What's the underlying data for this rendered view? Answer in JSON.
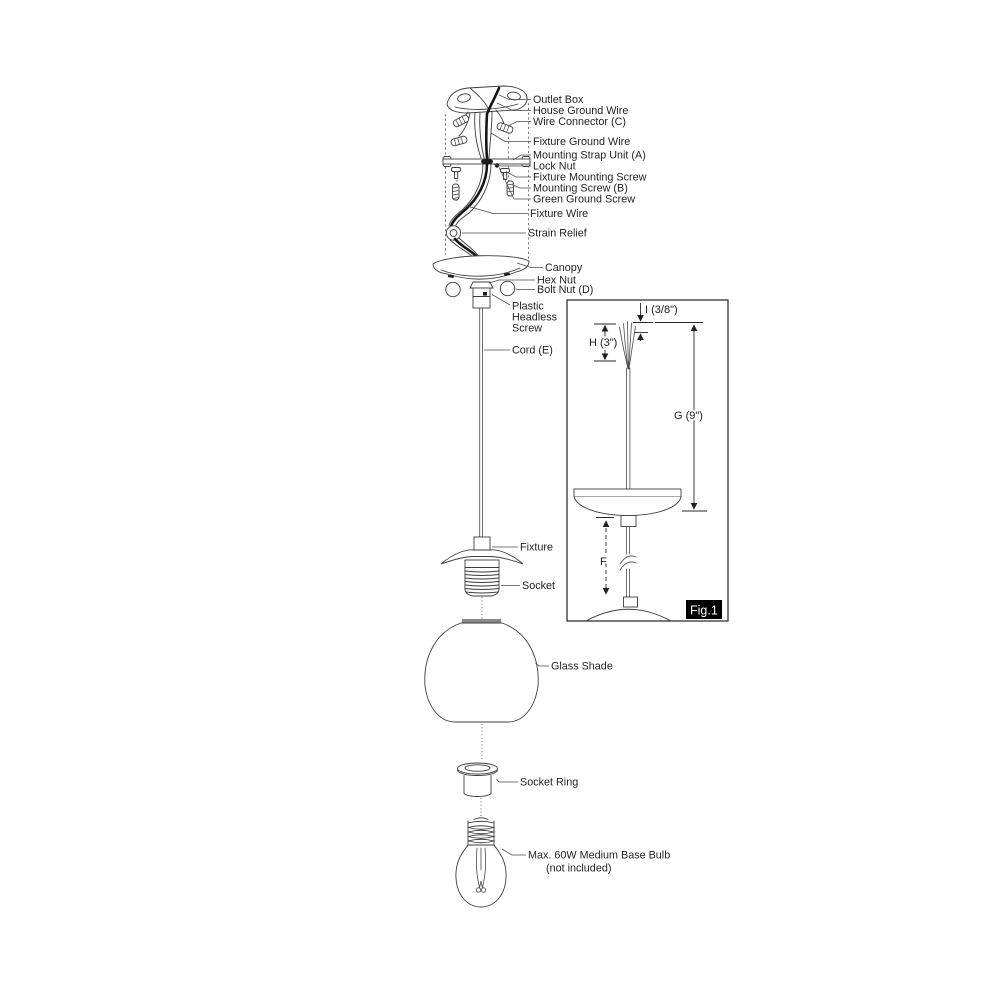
{
  "parts": {
    "outlet_box": "Outlet Box",
    "house_ground_wire": "House Ground Wire",
    "wire_connector": "Wire Connector (C)",
    "fixture_ground_wire": "Fixture Ground Wire",
    "mounting_strap": "Mounting Strap Unit (A)",
    "lock_nut": "Lock Nut",
    "fixture_mounting_screw": "Fixture Mounting Screw",
    "mounting_screw": "Mounting Screw (B)",
    "green_ground_screw": "Green Ground Screw",
    "fixture_wire": "Fixture Wire",
    "strain_relief": "Strain Relief",
    "canopy": "Canopy",
    "hex_nut": "Hex Nut",
    "bolt_nut": "Bolt Nut (D)",
    "plastic_headless_screw_line1": "Plastic",
    "plastic_headless_screw_line2": "Headless",
    "plastic_headless_screw_line3": "Screw",
    "cord": "Cord (E)",
    "fixture": "Fixture",
    "socket": "Socket",
    "glass_shade": "Glass Shade",
    "socket_ring": "Socket Ring",
    "bulb_line1": "Max. 60W Medium Base Bulb",
    "bulb_line2": "(not included)"
  },
  "figure1": {
    "caption": "Fig.1",
    "dim_i": "I (3/8\")",
    "dim_h": "H (3\")",
    "dim_g": "G (9\")",
    "dim_f": "F"
  },
  "colors": {
    "line": "#3d3d3d",
    "dark_wire": "#161616",
    "text": "#231f20",
    "fig_label_bg": "#000000",
    "fig_label_text": "#ffffff",
    "shade_band": "#8a8a8a",
    "background": "#ffffff"
  }
}
